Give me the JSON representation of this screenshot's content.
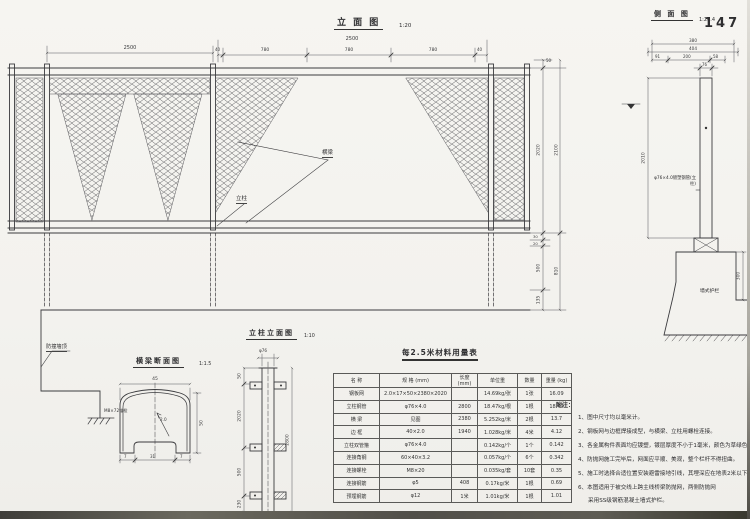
{
  "page_number": "147",
  "views": {
    "elevation": {
      "title": "立 面 图",
      "scale": "1:20",
      "dim_span_left": "2500",
      "dim_span_mid": "2500",
      "dim_40_l": "40",
      "dim_780_1": "780",
      "dim_780_2": "780",
      "dim_780_3": "780",
      "dim_40_r": "40",
      "label_beam": "横梁",
      "label_post": "立柱",
      "dim_50": "50",
      "dim_2020": "2020",
      "dim_2100": "2100",
      "dim_30": "30",
      "dim_20": "20",
      "dim_500": "500",
      "dim_135": "135",
      "dim_810": "810",
      "label_wall_top": "防撞墙顶",
      "label_anchor": "M8×72锚栓"
    },
    "side": {
      "title": "侧 面 图",
      "scale": "1:20.4",
      "dim_380": "380",
      "dim_404": "404",
      "dim_91": "91",
      "dim_200": "200",
      "dim_58": "58",
      "dim_76": "76",
      "dim_2010": "2010",
      "dim_300": "300",
      "label_post": "φ76×4.0镀塑钢管(立柱)",
      "label_wall": "墙式护栏"
    },
    "column": {
      "title": "立柱立面图",
      "scale": "1:10",
      "dim_phi": "φ76",
      "dim_c1": "50",
      "dim_c2": "2020",
      "dim_c3": "500",
      "dim_c4": "230",
      "dim_total": "2800"
    },
    "beam": {
      "title": "横梁断面图",
      "scale": "1:1.5",
      "dim_45": "45",
      "dim_50": "50",
      "dim_t": "2.0",
      "dim_b1": "7",
      "dim_b2": "31",
      "dim_b3": "7"
    }
  },
  "table": {
    "title": "每2.5米材料用量表",
    "columns": [
      "名 称",
      "规 格 (mm)",
      "长度 (mm)",
      "单位重",
      "数量",
      "重量 (kg)"
    ],
    "rows": [
      [
        "钢板网",
        "2.0×17×50×2380×2020",
        "",
        "14.69kg/张",
        "1张",
        "16.09"
      ],
      [
        "立柱钢管",
        "φ76×4.0",
        "2800",
        "18.47kg/根",
        "1根",
        "18.47"
      ],
      [
        "横 梁",
        "见图",
        "2380",
        "5.252kg/米",
        "2根",
        "13.7"
      ],
      [
        "边 框",
        "40×2.0",
        "1940",
        "1.028kg/米",
        "4米",
        "4.12"
      ],
      [
        "立柱双管箍",
        "φ76×4.0",
        "",
        "0.142kg/个",
        "1个",
        "0.142"
      ],
      [
        "连接角钢",
        "60×40×3.2",
        "",
        "0.057kg/个",
        "6个",
        "0.342"
      ],
      [
        "连接螺栓",
        "M8×20",
        "",
        "0.035kg/套",
        "10套",
        "0.35"
      ],
      [
        "连接钢筋",
        "φ5",
        "408",
        "0.17kg/米",
        "1根",
        "0.69"
      ],
      [
        "预埋钢筋",
        "φ12",
        "1米",
        "1.01kg/米",
        "1根",
        "1.01"
      ]
    ]
  },
  "notes": {
    "heading": "附注：",
    "items": [
      "1、图中尺寸均以毫米计。",
      "2、钢板网与边框焊接成型，与横梁、立柱用螺栓连接。",
      "3、各金属构件表面均应镀塑，镀层厚度不小于1毫米，颜色为草绿色。",
      "4、防抛网施工完毕后，网面应平顺、美观，整个栏杆不得扭曲。",
      "5、施工时选择合适位置安装避雷接地引线，其埋深应在地表2米以下。",
      "6、本图适用于被交线上跨主线桥梁防抛网，两侧防抛网",
      "采用SS级钢筋混凝土墙式护栏。"
    ]
  }
}
